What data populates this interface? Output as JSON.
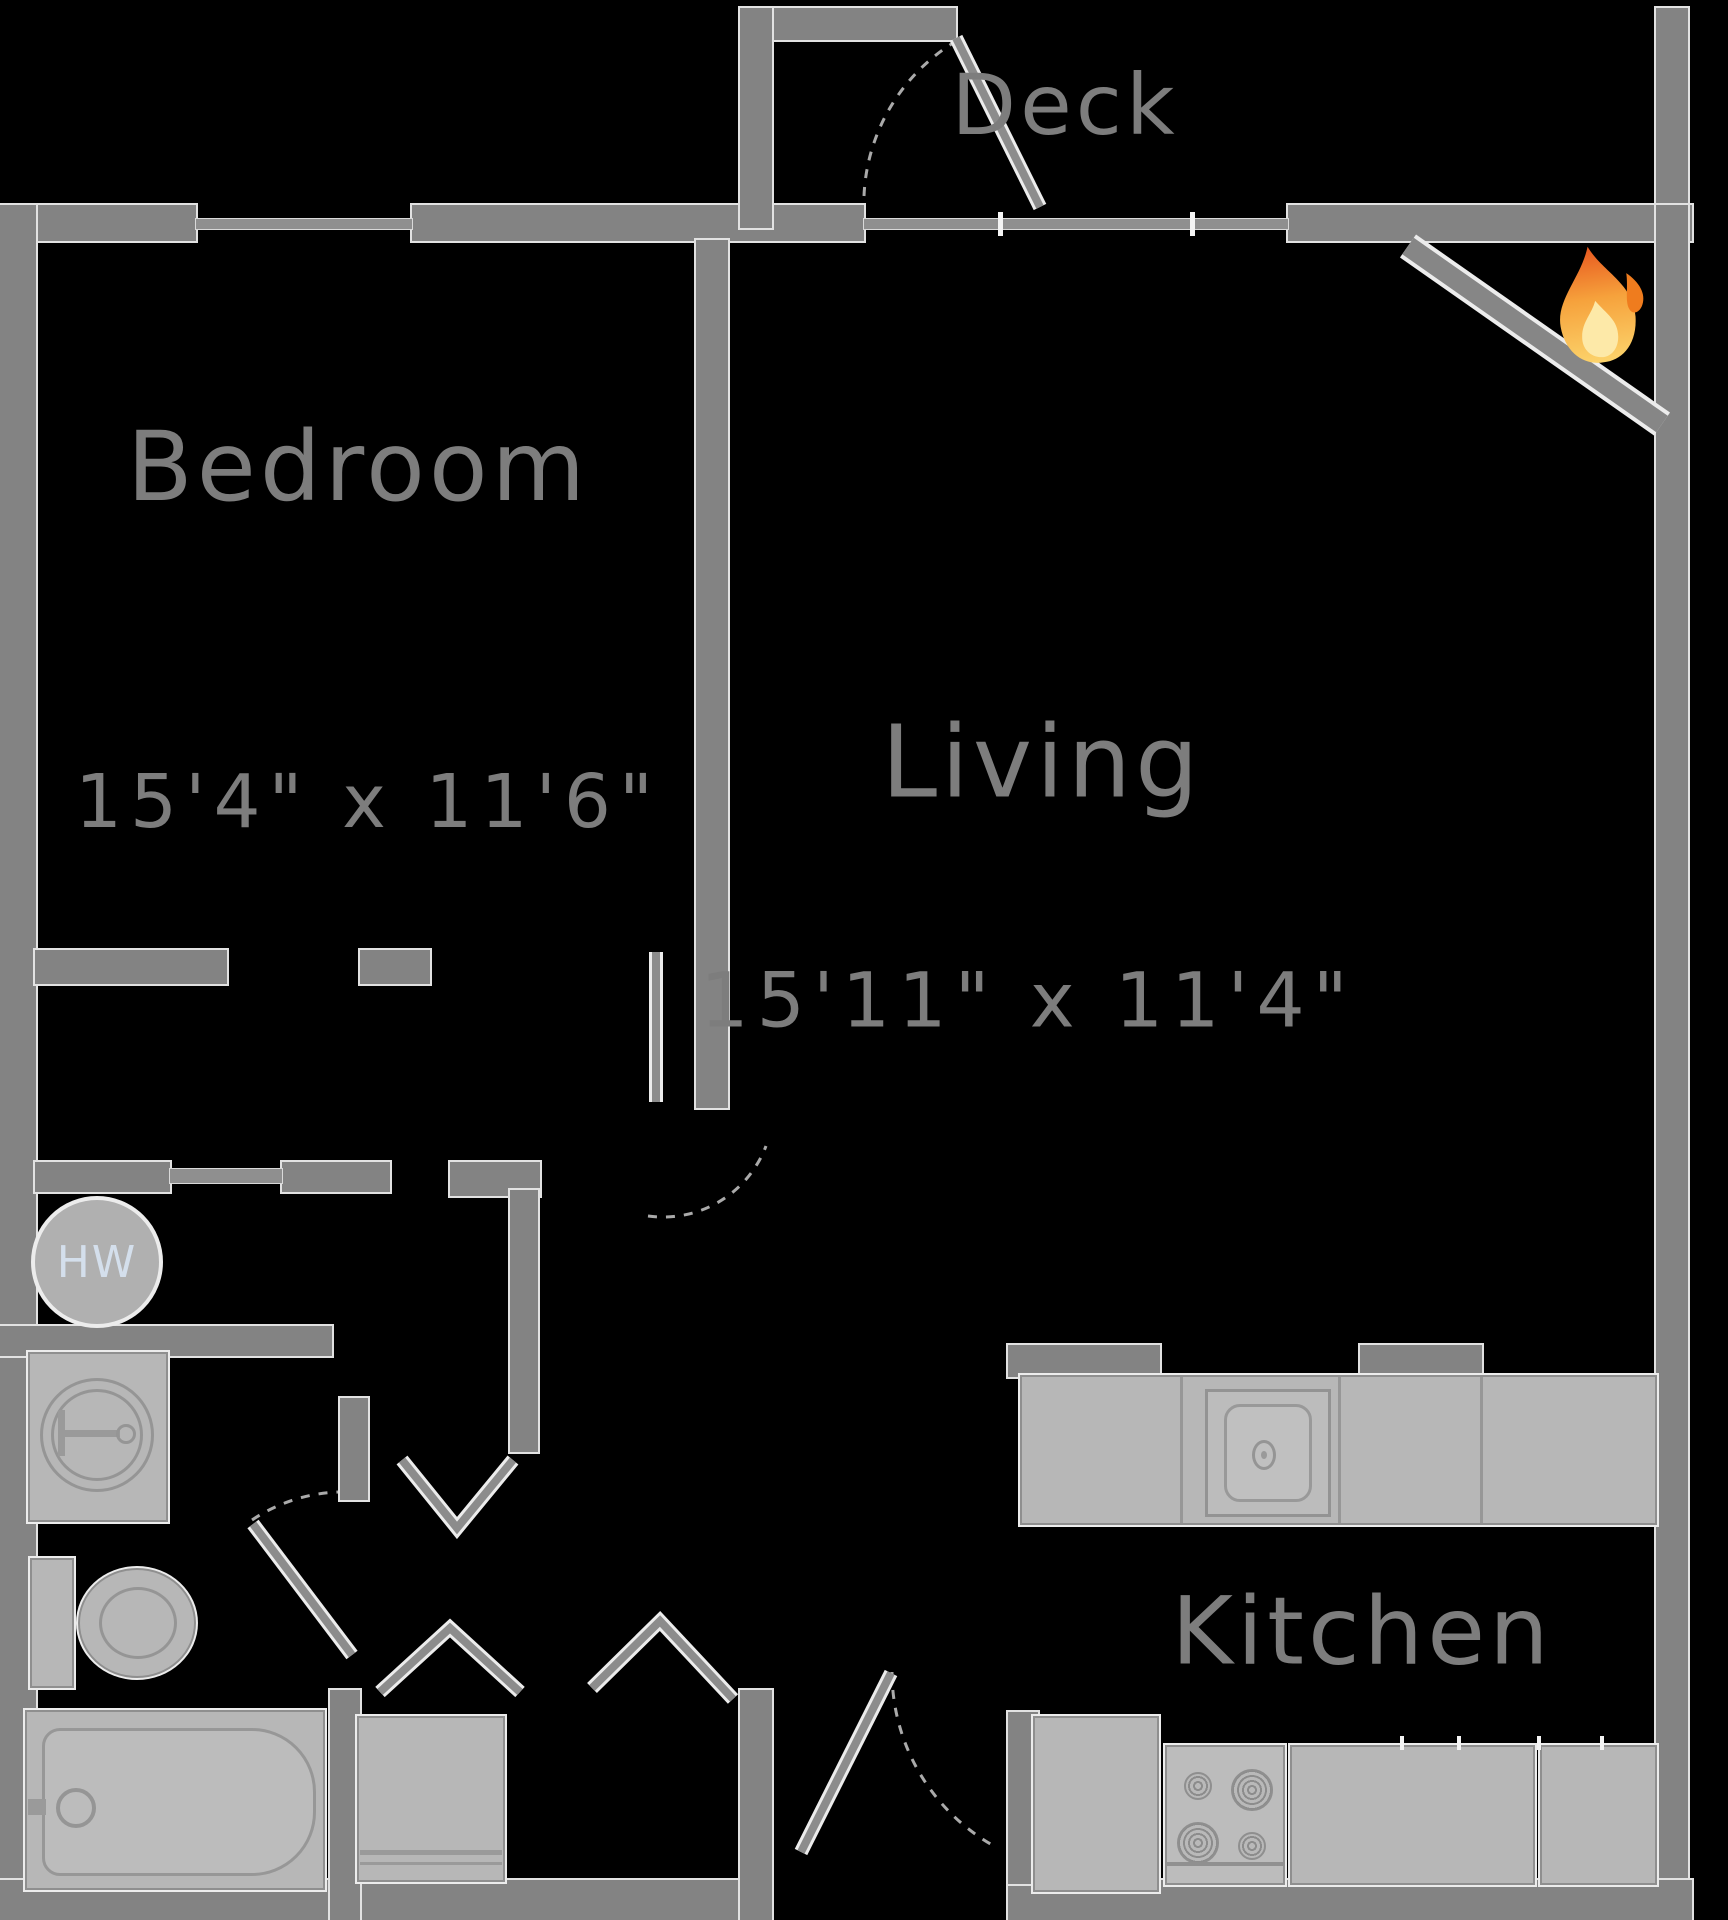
{
  "title": "One-bedroom apartment floor plan",
  "rooms": {
    "deck": {
      "label": "Deck"
    },
    "bedroom": {
      "label": "Bedroom",
      "dims": "15'4\" x 11'6\""
    },
    "living": {
      "label": "Living",
      "dims": "15'11\" x 11'4\""
    },
    "kitchen": {
      "label": "Kitchen"
    }
  },
  "fixtures": {
    "water_heater": {
      "label": "HW"
    },
    "fireplace_icon": "flame-icon",
    "bath_items": [
      "sink",
      "toilet",
      "bathtub",
      "washer"
    ],
    "kitchen_items": [
      "counter-with-sink",
      "refrigerator",
      "stove",
      "counter"
    ]
  },
  "colors": {
    "background": "#000000",
    "wall": "#838383",
    "wall_outline": "#e2e2e2",
    "fixture_fill": "#b7b7b7",
    "fixture_outline": "#8f8f8f",
    "label_text": "#7d7d7d",
    "hw_text": "#d4dfec",
    "flame_orange": "#ef7c1e",
    "flame_mid": "#f6a23c",
    "flame_yellow": "#fcd36b",
    "flame_core": "#fde9a8"
  }
}
